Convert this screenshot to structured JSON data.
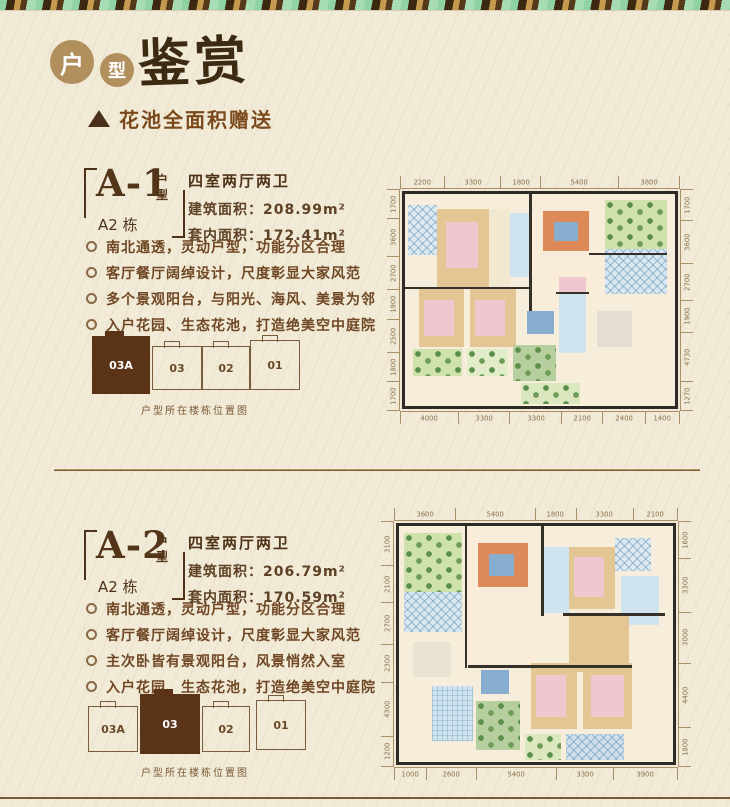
{
  "page": {
    "background": "#f1ead7",
    "accent_dark_brown": "#5b3317",
    "accent_gold": "#b2905e"
  },
  "header": {
    "badge1": "户",
    "badge2": "型",
    "calligraphy_title": "鉴赏",
    "subtitle": "花池全面积赠送",
    "triangle_icon": "filled-triangle"
  },
  "sections": [
    {
      "code": "A-1",
      "code_suffix": "户型",
      "building": "A2 栋",
      "layout_title": "四室两厅两卫",
      "built_area": "建筑面积：208.99m²",
      "inner_area": "套内面积：172.41m²",
      "bullets": [
        "南北通透，灵动户型，功能分区合理",
        "客厅餐厅阔绰设计，尺度彰显大家风范",
        "多个景观阳台，与阳光、海风、美景为邻",
        "入户花园、生态花池，打造绝美空中庭院"
      ],
      "position_caption": "户型所在楼栋位置图",
      "position_buildings": [
        {
          "label": "03A",
          "filled": true,
          "x": 12,
          "y": 4,
          "w": 56,
          "h": 56
        },
        {
          "label": "03",
          "filled": false,
          "x": 72,
          "y": 14,
          "w": 48,
          "h": 42
        },
        {
          "label": "02",
          "filled": false,
          "x": 122,
          "y": 14,
          "w": 46,
          "h": 42
        },
        {
          "label": "01",
          "filled": false,
          "x": 170,
          "y": 8,
          "w": 48,
          "h": 48
        }
      ],
      "plan": {
        "dims_top": [
          "2200",
          "3300",
          "1800",
          "5400",
          "3800"
        ],
        "dims_bottom": [
          "4000",
          "3300",
          "3300",
          "2100",
          "2400",
          "1400"
        ],
        "dims_left": [
          "1700",
          "3600",
          "2700",
          "1900",
          "2500",
          "1800",
          "1700"
        ],
        "dims_right": [
          "1700",
          "3600",
          "2700",
          "1900",
          "4730",
          "1270"
        ],
        "rooms": [
          {
            "x": 1,
            "y": 5,
            "w": 11,
            "h": 24,
            "c": "#dce9f1",
            "p": "d"
          },
          {
            "x": 12,
            "y": 7,
            "w": 19,
            "h": 37,
            "c": "#e3c694"
          },
          {
            "x": 15,
            "y": 13,
            "w": 12,
            "h": 22,
            "c": "#efc7cf"
          },
          {
            "x": 31,
            "y": 7,
            "w": 8,
            "h": 37,
            "c": "#f2e8cf"
          },
          {
            "x": 39,
            "y": 9,
            "w": 8,
            "h": 30,
            "c": "#cfe4ef"
          },
          {
            "x": 47,
            "y": 1,
            "w": 25,
            "h": 53,
            "c": "#f9edd9"
          },
          {
            "x": 51,
            "y": 8,
            "w": 17,
            "h": 19,
            "c": "#dd8a58"
          },
          {
            "x": 55,
            "y": 13,
            "w": 9,
            "h": 9,
            "c": "#87add0"
          },
          {
            "x": 74,
            "y": 3,
            "w": 23,
            "h": 23,
            "c": "#cfe2ad",
            "p": "g"
          },
          {
            "x": 74,
            "y": 26,
            "w": 23,
            "h": 21,
            "c": "#d9e8f0",
            "p": "d"
          },
          {
            "x": 71,
            "y": 55,
            "w": 13,
            "h": 17,
            "c": "#e4ded0"
          },
          {
            "x": 5,
            "y": 45,
            "w": 17,
            "h": 27,
            "c": "#e3c694"
          },
          {
            "x": 7,
            "y": 50,
            "w": 11,
            "h": 17,
            "c": "#efc7cf"
          },
          {
            "x": 24,
            "y": 45,
            "w": 17,
            "h": 27,
            "c": "#e3c694"
          },
          {
            "x": 26,
            "y": 50,
            "w": 11,
            "h": 17,
            "c": "#efc7cf"
          },
          {
            "x": 45,
            "y": 55,
            "w": 10,
            "h": 11,
            "c": "#87add0"
          },
          {
            "x": 57,
            "y": 47,
            "w": 10,
            "h": 28,
            "c": "#cfe4ef"
          },
          {
            "x": 57,
            "y": 39,
            "w": 10,
            "h": 8,
            "c": "#efc7cf"
          },
          {
            "x": 3,
            "y": 73,
            "w": 18,
            "h": 13,
            "c": "#cfe2ad",
            "p": "g"
          },
          {
            "x": 23,
            "y": 73,
            "w": 15,
            "h": 13,
            "c": "#e2ecc9",
            "p": "g"
          },
          {
            "x": 40,
            "y": 71,
            "w": 16,
            "h": 17,
            "c": "#b7cf9e",
            "p": "g"
          },
          {
            "x": 43,
            "y": 89,
            "w": 22,
            "h": 10,
            "c": "#dbe7bf",
            "p": "g"
          },
          {
            "x": 46,
            "y": 0,
            "w": 1,
            "h": 55,
            "c": "#35302a"
          },
          {
            "x": 0,
            "y": 44,
            "w": 46,
            "h": 1,
            "c": "#35302a"
          },
          {
            "x": 56,
            "y": 46,
            "w": 12,
            "h": 1,
            "c": "#35302a"
          },
          {
            "x": 68,
            "y": 28,
            "w": 29,
            "h": 1,
            "c": "#35302a"
          }
        ]
      }
    },
    {
      "code": "A-2",
      "code_suffix": "户型",
      "building": "A2 栋",
      "layout_title": "四室两厅两卫",
      "built_area": "建筑面积：206.79m²",
      "inner_area": "套内面积：170.59m²",
      "bullets": [
        "南北通透，灵动户型，功能分区合理",
        "客厅餐厅阔绰设计，尺度彰显大家风范",
        "主次卧皆有景观阳台，风景悄然入室",
        "入户花园、生态花池，打造绝美空中庭院"
      ],
      "position_caption": "户型所在楼栋位置图",
      "position_buildings": [
        {
          "label": "03A",
          "filled": false,
          "x": 8,
          "y": 12,
          "w": 48,
          "h": 44
        },
        {
          "label": "03",
          "filled": true,
          "x": 60,
          "y": 0,
          "w": 58,
          "h": 58
        },
        {
          "label": "02",
          "filled": false,
          "x": 122,
          "y": 12,
          "w": 46,
          "h": 44
        },
        {
          "label": "01",
          "filled": false,
          "x": 176,
          "y": 6,
          "w": 48,
          "h": 48
        }
      ],
      "plan": {
        "dims_top": [
          "3600",
          "5400",
          "1800",
          "3300",
          "2100"
        ],
        "dims_bottom": [
          "1000",
          "2600",
          "5400",
          "3300",
          "3900"
        ],
        "dims_left": [
          "3100",
          "2100",
          "2700",
          "2300",
          "4300",
          "1200"
        ],
        "dims_right": [
          "1600",
          "3300",
          "3000",
          "4400",
          "1800"
        ],
        "rooms": [
          {
            "x": 2,
            "y": 3,
            "w": 21,
            "h": 25,
            "c": "#cfe2ad",
            "p": "g"
          },
          {
            "x": 2,
            "y": 28,
            "w": 21,
            "h": 17,
            "c": "#d9e8f0",
            "p": "d"
          },
          {
            "x": 5,
            "y": 49,
            "w": 14,
            "h": 15,
            "c": "#eae3d1"
          },
          {
            "x": 25,
            "y": 1,
            "w": 26,
            "h": 58,
            "c": "#f9edd9"
          },
          {
            "x": 29,
            "y": 7,
            "w": 18,
            "h": 19,
            "c": "#dd8a58"
          },
          {
            "x": 33,
            "y": 12,
            "w": 9,
            "h": 9,
            "c": "#87add0"
          },
          {
            "x": 53,
            "y": 9,
            "w": 9,
            "h": 28,
            "c": "#cfe4ef"
          },
          {
            "x": 62,
            "y": 9,
            "w": 17,
            "h": 26,
            "c": "#e3c694"
          },
          {
            "x": 64,
            "y": 13,
            "w": 11,
            "h": 17,
            "c": "#efc7cf"
          },
          {
            "x": 79,
            "y": 5,
            "w": 13,
            "h": 14,
            "c": "#dce9f1",
            "p": "d"
          },
          {
            "x": 81,
            "y": 21,
            "w": 14,
            "h": 21,
            "c": "#cfe4ef"
          },
          {
            "x": 62,
            "y": 37,
            "w": 22,
            "h": 25,
            "c": "#e3c694"
          },
          {
            "x": 30,
            "y": 61,
            "w": 10,
            "h": 10,
            "c": "#87add0"
          },
          {
            "x": 12,
            "y": 68,
            "w": 15,
            "h": 23,
            "c": "#cfe4ef",
            "p": "k"
          },
          {
            "x": 28,
            "y": 74,
            "w": 16,
            "h": 21,
            "c": "#b7cf9e",
            "p": "g"
          },
          {
            "x": 48,
            "y": 58,
            "w": 17,
            "h": 28,
            "c": "#e3c694"
          },
          {
            "x": 50,
            "y": 63,
            "w": 11,
            "h": 18,
            "c": "#efc7cf"
          },
          {
            "x": 67,
            "y": 58,
            "w": 18,
            "h": 28,
            "c": "#e3c694"
          },
          {
            "x": 70,
            "y": 63,
            "w": 12,
            "h": 18,
            "c": "#efc7cf"
          },
          {
            "x": 46,
            "y": 88,
            "w": 13,
            "h": 11,
            "c": "#dbe7bf",
            "p": "g"
          },
          {
            "x": 61,
            "y": 88,
            "w": 21,
            "h": 11,
            "c": "#cfe0ec",
            "p": "d"
          },
          {
            "x": 24,
            "y": 0,
            "w": 1,
            "h": 60,
            "c": "#35302a"
          },
          {
            "x": 52,
            "y": 0,
            "w": 1,
            "h": 38,
            "c": "#35302a"
          },
          {
            "x": 25,
            "y": 59,
            "w": 60,
            "h": 1,
            "c": "#35302a"
          },
          {
            "x": 60,
            "y": 37,
            "w": 37,
            "h": 1,
            "c": "#35302a"
          }
        ]
      }
    }
  ]
}
